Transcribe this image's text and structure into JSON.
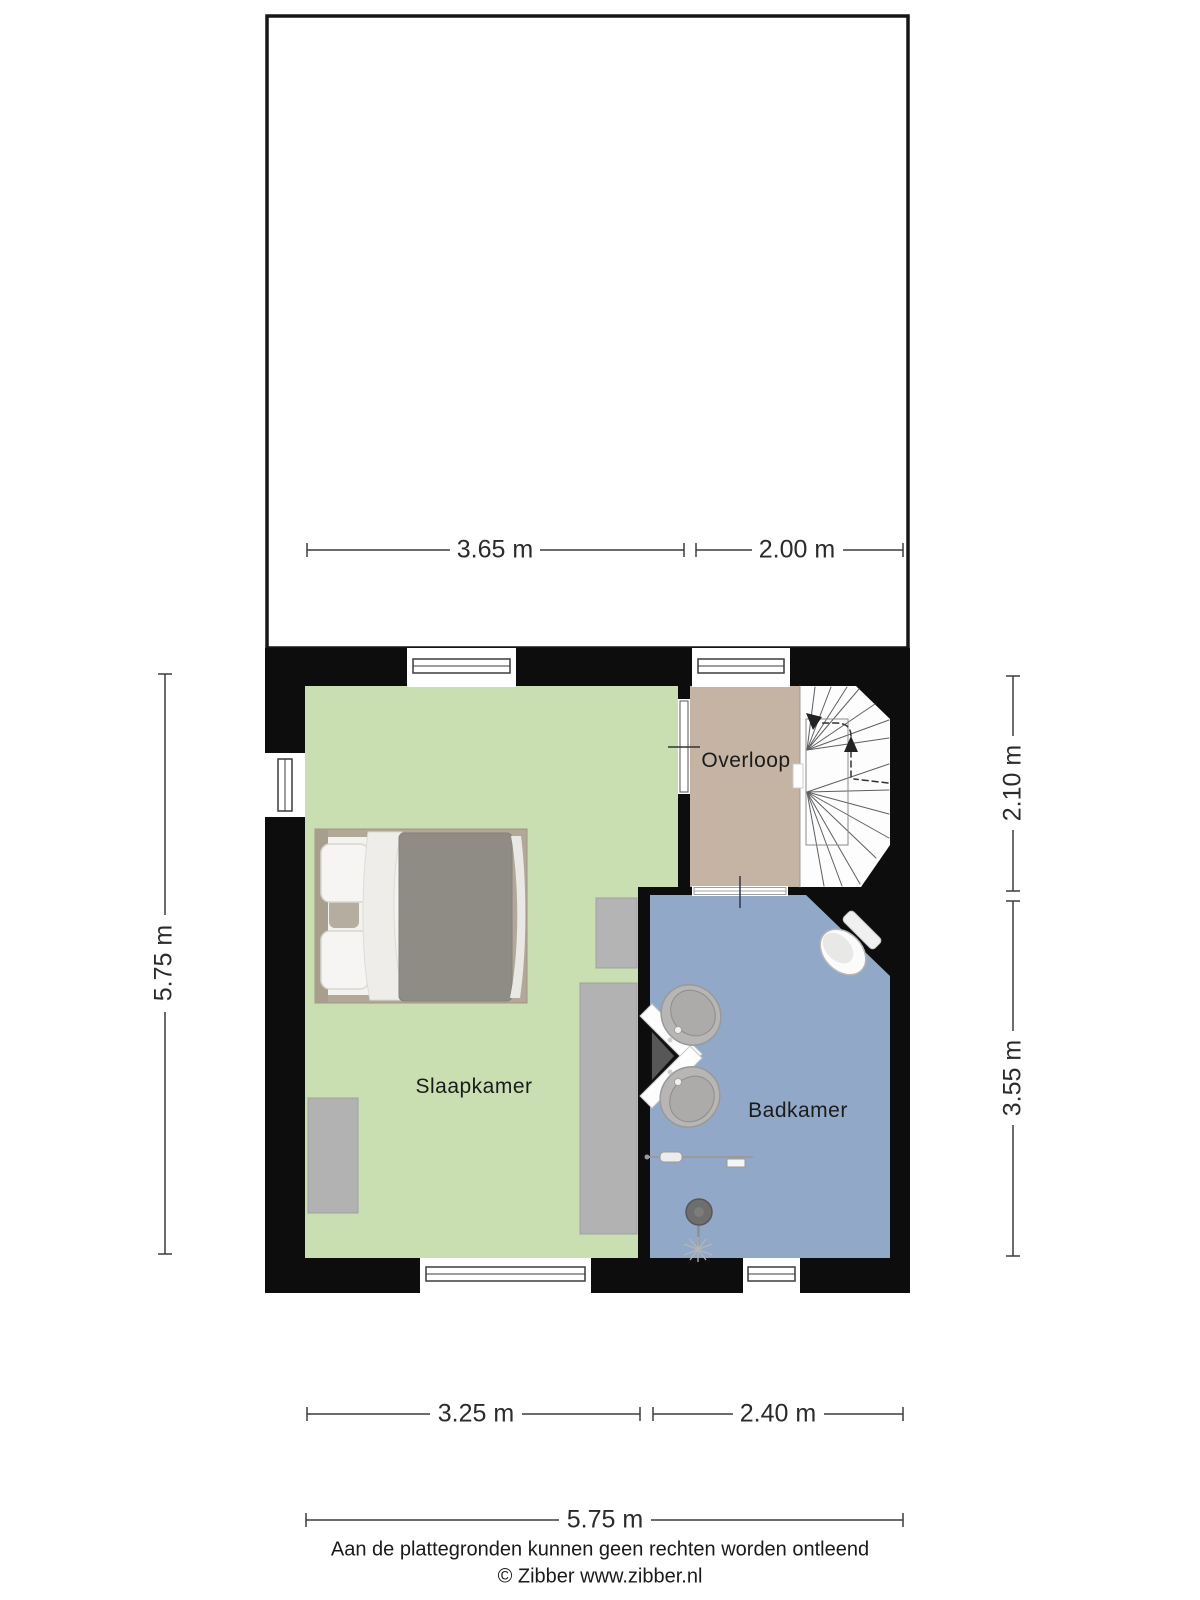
{
  "document": {
    "type": "floor-plan",
    "background": "#ffffff"
  },
  "floorplan": {
    "wall_color": "#0d0d0d",
    "rooms": [
      {
        "name": "Slaapkamer",
        "color": "#c9dfb2"
      },
      {
        "name": "Overloop",
        "color": "#c5b3a3"
      },
      {
        "name": "Badkamer",
        "color": "#92a8c8"
      }
    ],
    "attic": {
      "color": "#ffffff"
    },
    "furniture": [
      "double-bed",
      "nightstand",
      "wardrobe",
      "dresser",
      "corner-vanity-with-two-sinks",
      "toilet",
      "shower",
      "towel-rail",
      "winder-staircase"
    ]
  },
  "dimensions": {
    "attic_width_left": "3.65 m",
    "attic_width_right": "2.00 m",
    "floor_height_left": "5.75 m",
    "landing_height_right": "2.10 m",
    "bathroom_height_right": "3.55 m",
    "bedroom_width_bottom": "3.25 m",
    "bathroom_width_bottom": "2.40 m",
    "total_width_bottom": "5.75 m"
  },
  "footer": {
    "disclaimer": "Aan de plattegronden kunnen geen rechten worden ontleend",
    "copyright": "© Zibber www.zibber.nl"
  }
}
